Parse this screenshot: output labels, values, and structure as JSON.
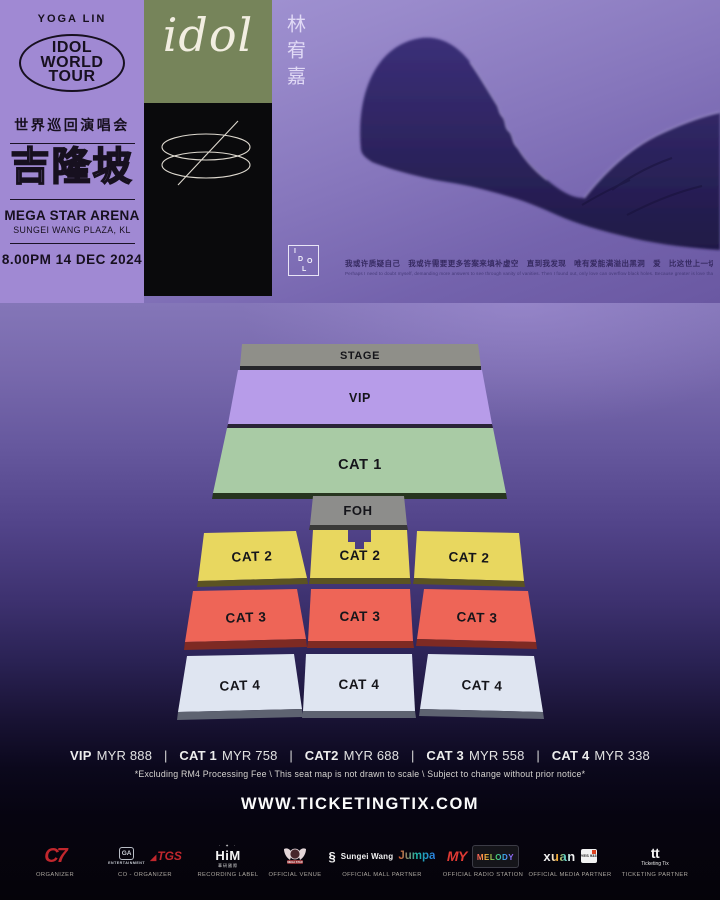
{
  "poster": {
    "artist": "YOGA LIN",
    "tour_badge_lines": [
      "IDOL",
      "WORLD",
      "TOUR"
    ],
    "tour_subtitle_cn": "世界巡回演唱会",
    "city_cn": "吉隆坡",
    "venue": "MEGA STAR ARENA",
    "venue_address": "SUNGEI WANG PLAZA, KL",
    "datetime": "8.00PM 14 DEC 2024",
    "wordmark": "idol",
    "artist_cn": "林宥嘉",
    "idol_box_letters": [
      "I",
      "D",
      "O",
      "L"
    ],
    "lyric_cn": "我或许质疑自己　我或许需要更多答案来填补虚空　直到我发现　唯有爱能满溢出黑洞　爱　比这世上一切你我所能想到的更巨大",
    "lyric_en": "Perhaps I need to doubt myself, demanding more answers to see through vanity of vanities. Then I found out, only love can overflow black holes. Because greater is love that is in you than that is in the world."
  },
  "seatmap": {
    "labels": {
      "stage": "STAGE",
      "vip": "VIP",
      "cat1": "CAT 1",
      "foh": "FOH",
      "cat2": "CAT 2",
      "cat3": "CAT 3",
      "cat4": "CAT 4"
    }
  },
  "pricing": {
    "items": [
      {
        "label": "VIP",
        "price": "MYR 888"
      },
      {
        "label": "CAT 1",
        "price": "MYR 758"
      },
      {
        "label": "CAT2",
        "price": "MYR 688"
      },
      {
        "label": "CAT 3",
        "price": "MYR 558"
      },
      {
        "label": "CAT 4",
        "price": "MYR 338"
      }
    ],
    "separator": "|",
    "disclaimer": "*Excluding RM4 Processing Fee   \\   This seat map is not drawn to scale   \\   Subject to change without prior notice*"
  },
  "website": "WWW.TICKETINGTIX.COM",
  "sponsors": [
    {
      "text": "C7",
      "label": "ORGANIZER"
    },
    {
      "monogram": "GA",
      "sub": "ENTERTAINMENT",
      "second": "TGS",
      "label": "CO - ORGANIZER"
    },
    {
      "stars": "· ✦ ·",
      "text": "HiM",
      "sub": "華研國際",
      "label": "RECORDING LABEL"
    },
    {
      "text": "MEGA STAR",
      "label": "OFFICIAL VENUE"
    },
    {
      "glyph": "§",
      "first": "Sungei Wang",
      "second": "Jumpa",
      "label": "OFFICIAL MALL PARTNER"
    },
    {
      "first": "MY",
      "second": "MELODY",
      "label": "OFFICIAL RADIO STATION"
    },
    {
      "first": "xuan",
      "second": "YES 933",
      "label": "OFFICIAL MEDIA PARTNER"
    },
    {
      "glyph": "tt",
      "text": "Ticketing Tix",
      "label": "TICKETING PARTNER"
    }
  ],
  "colors": {
    "panel": "#a089d3",
    "green": "#76845a",
    "stage": "#8f8f89",
    "vip": "#b79ce9",
    "cat1": "#a9cba5",
    "foh": "#8d8d8b",
    "cat2": "#e8d75f",
    "cat3": "#ee6557",
    "cat4": "#dfe5f1"
  }
}
